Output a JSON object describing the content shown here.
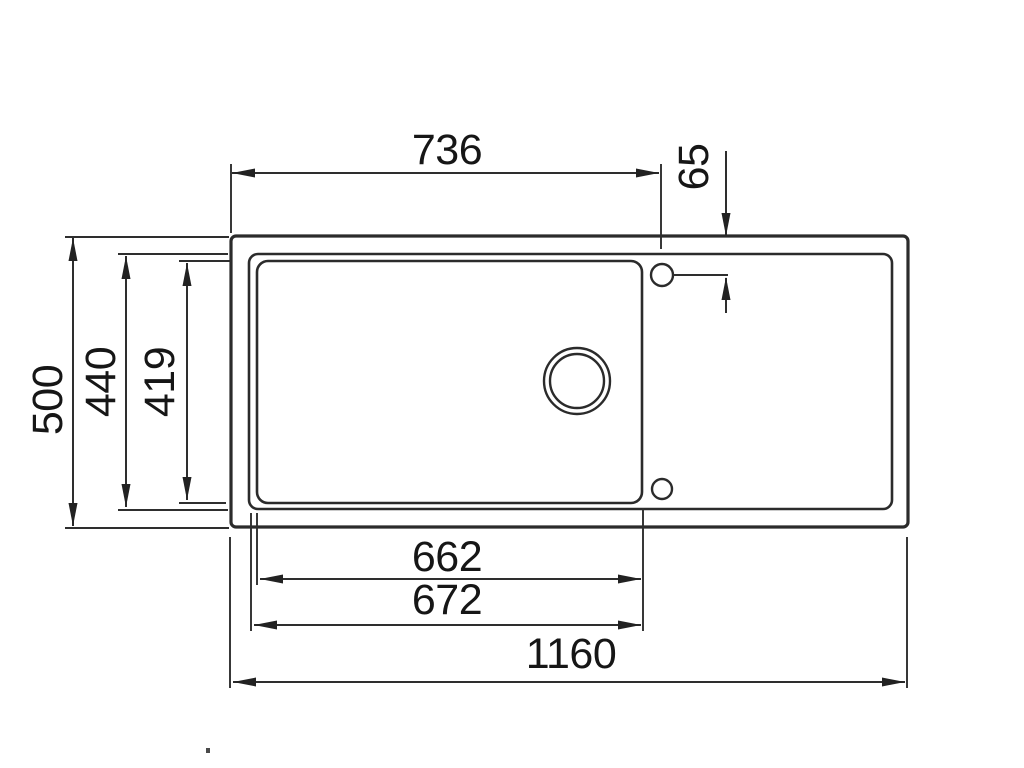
{
  "drawing": {
    "name": "sink-top-view-technical-drawing",
    "unit": "mm",
    "line_color": "#2b2b2b",
    "text_color": "#161616",
    "background": "#ffffff",
    "labels": {
      "d736": "736",
      "d65": "65",
      "d500": "500",
      "d440": "440",
      "d419": "419",
      "d662": "662",
      "d672": "672",
      "d1160": "1160"
    },
    "dimensions": [
      {
        "value": 736,
        "orientation": "horizontal",
        "measures": "left edge to tap-hole centerline"
      },
      {
        "value": 65,
        "orientation": "vertical",
        "measures": "top edge to tap-hole centerline"
      },
      {
        "value": 500,
        "orientation": "vertical",
        "measures": "overall depth"
      },
      {
        "value": 440,
        "orientation": "vertical",
        "measures": "inner rim depth"
      },
      {
        "value": 419,
        "orientation": "vertical",
        "measures": "bowl depth"
      },
      {
        "value": 662,
        "orientation": "horizontal",
        "measures": "bowl inner width"
      },
      {
        "value": 672,
        "orientation": "horizontal",
        "measures": "bowl outer width"
      },
      {
        "value": 1160,
        "orientation": "horizontal",
        "measures": "overall width"
      }
    ]
  }
}
